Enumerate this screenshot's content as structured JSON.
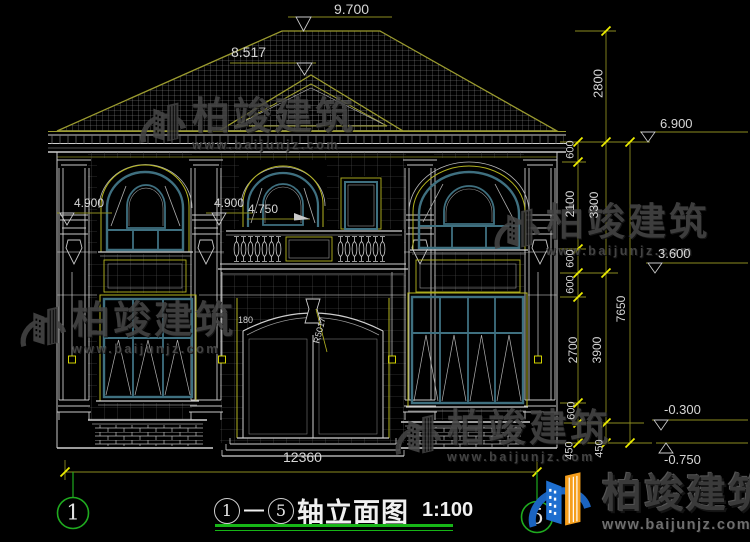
{
  "drawing_title": {
    "axis_from": "1",
    "dash": "—",
    "axis_to": "5",
    "name": "轴立面图",
    "scale": "1:100"
  },
  "axes": {
    "left_bubble": "1",
    "right_bubble": "5"
  },
  "elevation_marks": {
    "ridge": "9.700",
    "pediment": "8.517",
    "eave": "6.900",
    "second_floor": "3.600",
    "ground_offset": "-0.300",
    "footing": "-0.750",
    "balcony_left": "4.900",
    "balcony_center": "4.900",
    "balcony_rail": "4.750"
  },
  "vertical_dims": {
    "roof": "2800",
    "eave_band": "600",
    "window2f": "2100",
    "story2": "3300",
    "sill_band": "600",
    "head_band": "600",
    "window1f": "2700",
    "story1": "3900",
    "total_height": "7650",
    "plinth_band": "600",
    "step_a": "450",
    "step_b": "450"
  },
  "horizontal_dims": {
    "overall_width": "12360"
  },
  "door_labels": {
    "arch_radius": "R5017",
    "arch_offset": "180"
  },
  "watermark": {
    "company": "柏竣建筑",
    "website": "www.baijunjz.com"
  },
  "brand_logo": {
    "company": "柏竣建筑",
    "website": "www.baijunjz.com"
  },
  "colors": {
    "background": "#000000",
    "dim_line": "#8b8b1f",
    "tick": "#ecec00",
    "outline": "#c9c9c9",
    "window_frame": "#3f7080",
    "trim": "#b5b520",
    "axis_green": "#1faa1f",
    "underline_green": "#17b517",
    "logo_blue": "#1b64c0",
    "logo_orange": "#f59e1c"
  }
}
